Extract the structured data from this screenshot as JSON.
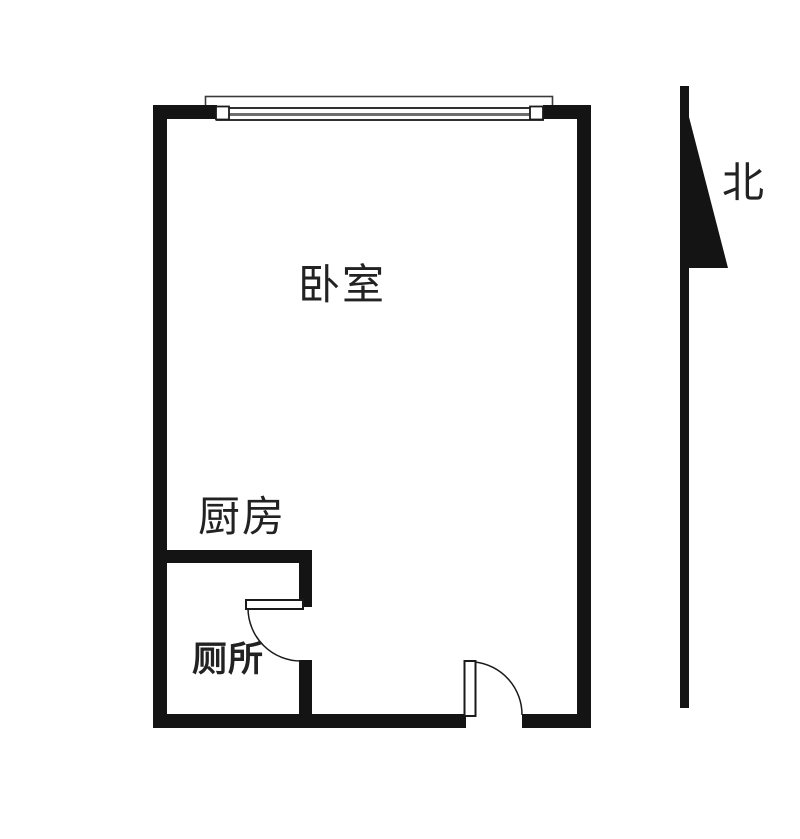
{
  "floorplan": {
    "rooms": {
      "bedroom_label": "卧室",
      "kitchen_label": "厨房",
      "toilet_label": "厕所"
    },
    "compass": {
      "north_label": "北"
    },
    "colors": {
      "background": "#ffffff",
      "wall": "#141414",
      "text": "#222222",
      "door_line": "#1a1a1a",
      "window_frame": "#1a1a1a",
      "window_outline": "#3a3a3a",
      "window_midline": "#6e6e6e",
      "fixture_fill": "#ffffff"
    }
  }
}
